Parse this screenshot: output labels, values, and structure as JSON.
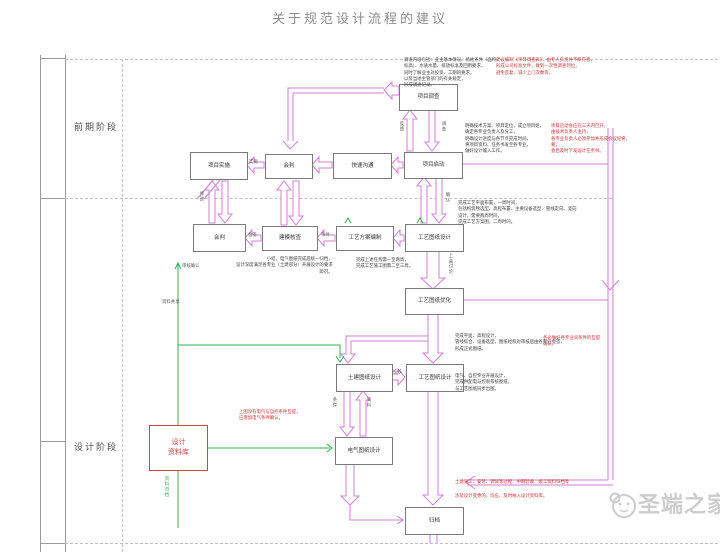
{
  "title": "关于规范设计流程的建议",
  "stages": {
    "early": "前期阶段",
    "design": "设计阶段"
  },
  "boxes": {
    "survey": "项目调查",
    "impl": "项目实施",
    "meet2": "会判",
    "quick": "快速沟通",
    "start": "项目启动",
    "meet3": "会判",
    "model": "建模核查",
    "scheme": "工艺方案编制",
    "process_design": "工艺图纸设计",
    "optimize": "工艺图纸优化",
    "civil": "土建图纸设计",
    "process_final": "工艺图纸设计",
    "electric": "电气图纸设计",
    "library": "设计\n资料库",
    "archive": "归档"
  },
  "labels": {
    "fankui": "反馈",
    "diaocha": "调查",
    "shishi": "实施",
    "xiugai": "修改",
    "huiqian": "会签",
    "tiaojian": "条件",
    "queren": "确认",
    "shanghui": "上会讨论",
    "jiaohe": "校核",
    "dq_tiaojian": "条件",
    "dq_ziliao": "资料",
    "shenhe": "审核确认",
    "gongxiang": "资料共享",
    "guidang": "资料归档"
  },
  "annotations": {
    "ann1_black": "调查内容包括：业主基本情况、场地条件（面积、\n标高）、水质水量、排放标准及回用要求，\n同时了解业主对投资、工期的要求，\n以及当地主管部门的有关规定，\n形成调查记录。",
    "ann1_red": "建议编制《项目调查表》，由专人负责并不断完善，\n形成公司标准文件，做到一次性调查到位，\n避免反复、减少上门次数等。",
    "ann2_black": "明确技术方案、项目定位，成立项目组，\n确定各专业负责人及分工，\n明确设计进度与各节点完成时间，\n将项目资料、任务书发至各专业，\n做好设计输入工作。",
    "ann2_red": "项目启动会应在三天内召开，\n由技术负责人主持，\n各专业负责人必须参加并形成会议纪要，\n要，\n会后及时下发设计任务书。",
    "ann3_black": "完成工艺平面布置，一周时间，\n包括构筑物选型、高程布置、主要设备选型／管线走向、竖向\n设计，需要两周时间，\n完成工艺方案图，二周时间。",
    "ann4a_black": "小结，电气图纸完成后统一归档，\n设计深度满足各专业（土建部分）开展设计的要求\n即可。",
    "ann4b_black": "完成上述任务需一至两周，\n完成工艺施工图需二至三周。",
    "ann5_black": "完成平面、高程设计，\n管线综合、设备选型，图纸经校对审核后由各专业会签，\n形成正式图纸。",
    "ann5_red": "务必做好各专业间条件的互提\n确认。",
    "ann6_black": "电气、自控专业开展设计，\n完成供配电与控制系统图纸，\n与工艺图纸同步出图。",
    "ann7_red": "上图没有电气与自控条件互提，\n应增加电气条件确认。",
    "ann8a_red": "土建施工、安装、调试等过程、中期验收、竣工资料归档等",
    "ann8b_red": "涉及设计变更的，均应、及时纳入设计资料库。"
  },
  "watermark": {
    "text": "圣端之家"
  },
  "colors": {
    "accent": "#d27fd2",
    "green": "#2db04e",
    "red": "#cc4545"
  }
}
